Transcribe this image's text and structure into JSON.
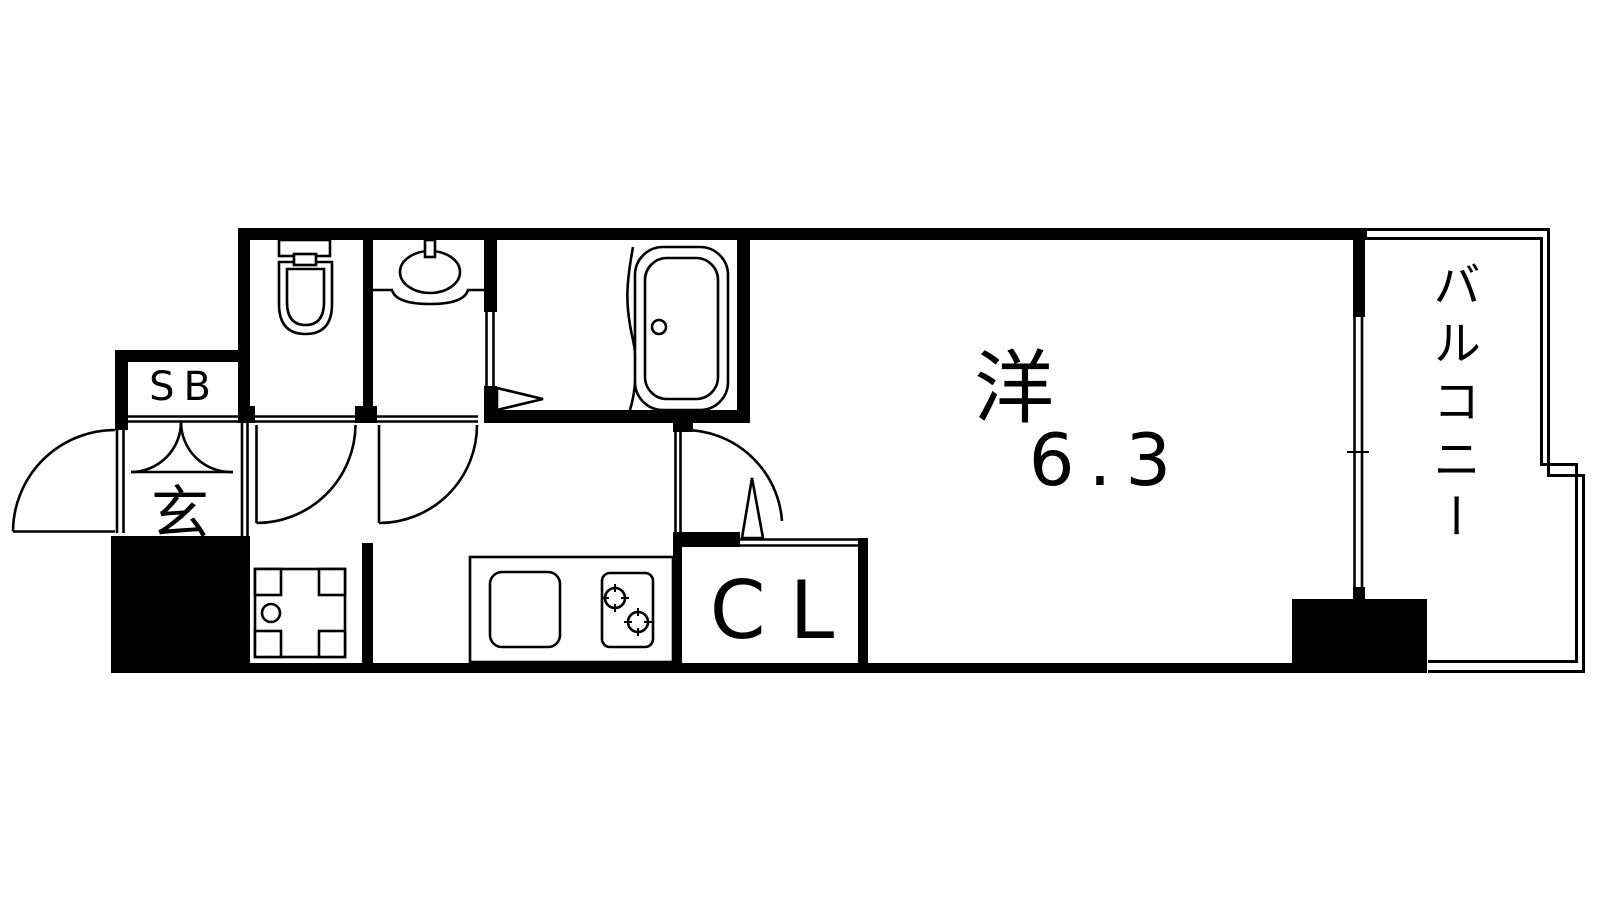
{
  "page": {
    "background_color": "#ffffff",
    "line_color": "#000000",
    "type": "apartment floor plan"
  },
  "floor_plan": {
    "labels": {
      "western_room": "洋",
      "western_room_size": "6.3",
      "balcony": "バルコニー",
      "closet": "CL",
      "shoe_box": "SB",
      "entrance": "玄"
    },
    "fixtures": [
      "toilet",
      "washbasin",
      "bathtub",
      "washing-machine-pan",
      "kitchen-counter",
      "kitchen-sink",
      "two-burner-stove",
      "entrance-door",
      "interior-swing-doors",
      "sliding-window",
      "structural-pillar"
    ]
  }
}
